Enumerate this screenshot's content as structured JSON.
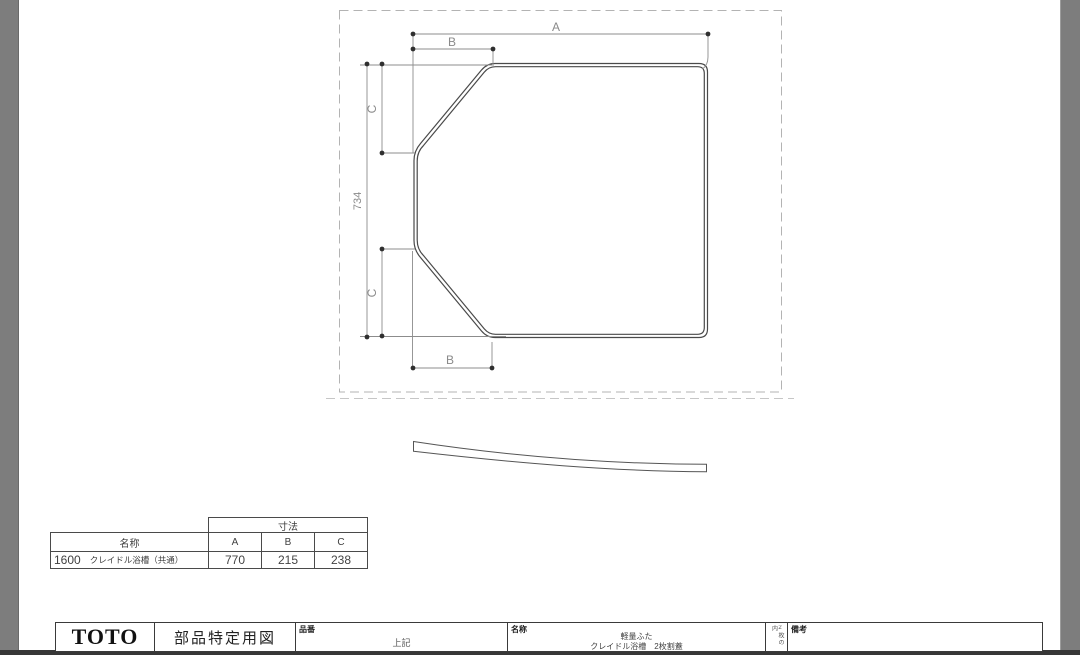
{
  "drawing": {
    "labels": {
      "dim_a": "A",
      "dim_b_top": "B",
      "dim_b_bottom": "B",
      "dim_c_top": "C",
      "dim_c_bottom": "C",
      "dim_height": "734"
    }
  },
  "dim_table": {
    "dim_header": "寸法",
    "name_header": "名称",
    "columns": [
      "A",
      "B",
      "C"
    ],
    "row": {
      "size": "1600",
      "name": "クレイドル浴槽（共通）",
      "values": [
        "770",
        "215",
        "238"
      ]
    }
  },
  "title_block": {
    "logo": "TOTO",
    "doc_type": "部品特定用図",
    "part_number_label": "品番",
    "part_number_value": "上記",
    "name_label": "名称",
    "name_value_line1": "軽量ふた",
    "name_value_line2": "クレイドル浴槽　2枚割蓋",
    "sheet_note": "2枚の内",
    "remarks_label": "備考"
  }
}
